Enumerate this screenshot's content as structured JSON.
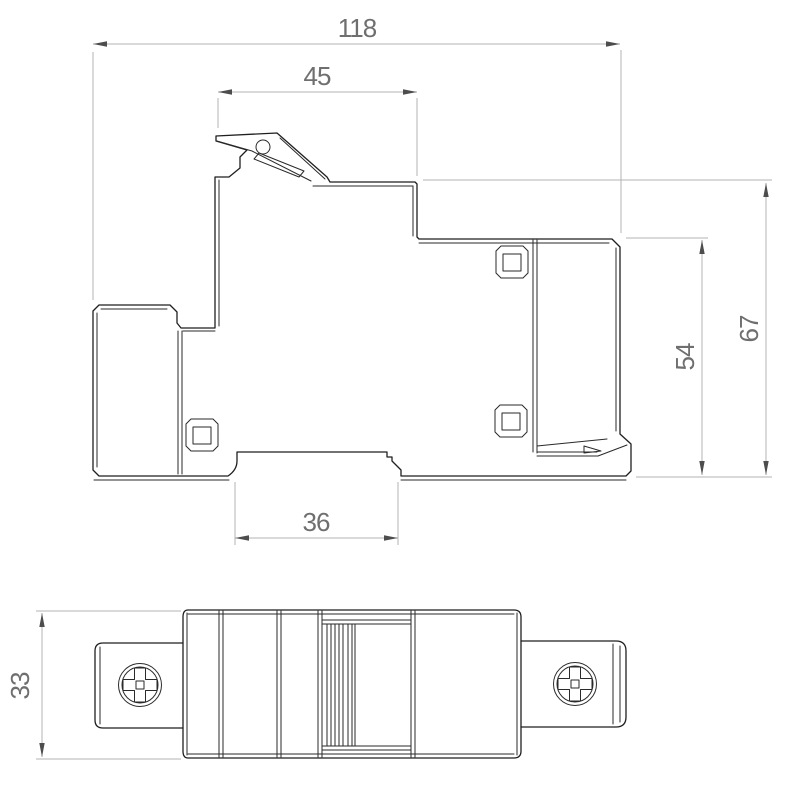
{
  "dims": {
    "overall_width": "118",
    "upper_width": "45",
    "overall_height": "67",
    "body_height": "54",
    "slot_width": "36",
    "depth": "33"
  },
  "colors": {
    "outline": "#1f1f1f",
    "dimension_line": "#b3b3b3",
    "dimension_text": "#6f6f6f",
    "arrowhead": "#4d4d4d",
    "background": "#ffffff"
  }
}
